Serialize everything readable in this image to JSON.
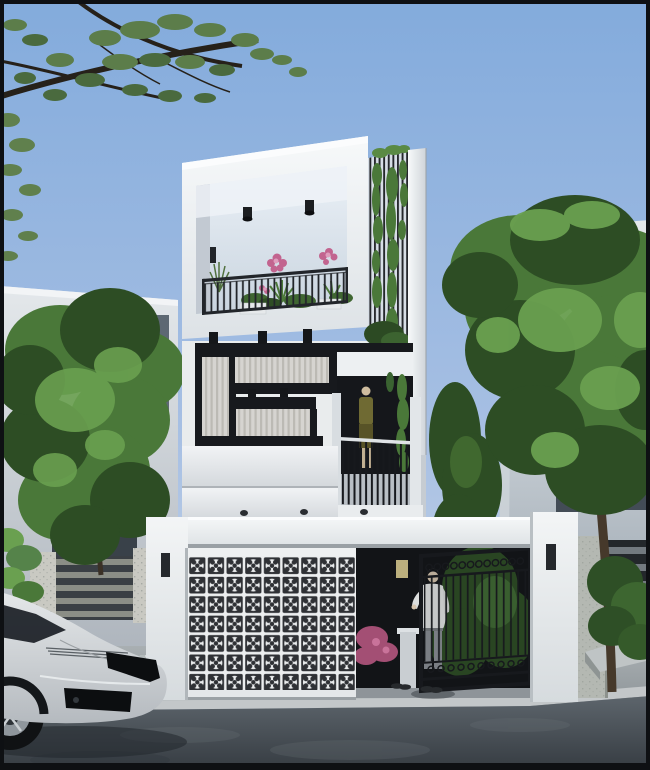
{
  "scene": {
    "subject": "modern-three-storey-townhouse-street-render",
    "setting": "daytime-street-front",
    "main_house": {
      "floors": 3,
      "terrace_ceiling_lights": 2,
      "terrace_wall_sconce": 1,
      "facade_lights_upper_beam": 3,
      "facade_lights_mid_beam": 2,
      "under_parapet_lights": 3,
      "vine_screen": "vertical-slat-screen-with-climbing-plants",
      "balcony_figure": "mannequin-in-olive-dress",
      "breeze_block_gate_grid": {
        "cols": 9,
        "rows": 7
      },
      "fence_wall_sconces": 2,
      "entry_pillar_sconce": 1,
      "terrace_plants": "pink-flowers-and-green-spiky-plants"
    },
    "street": {
      "parked_car": "white-sports-car-front",
      "pedestrian": "man-light-shirt-grey-trousers",
      "shoe_pairs_at_entrance": 2,
      "entry_gate": "dark-wrought-iron-gate-open"
    },
    "vegetation": {
      "top_left": "overhanging-dark-branches-with-leaves",
      "left": "green-tree-in-front-of-left-house",
      "right": "large-green-tree-with-shrub-and-planter"
    },
    "neighbors": {
      "left": "white-two-storey-house-with-slot-windows",
      "right": "white-multi-storey-house-behind-tree"
    }
  },
  "palette": {
    "sky_top": "#83abdc",
    "sky_mid": "#a6bfe3",
    "sky_low": "#cfd9e8",
    "white_hi": "#f7f9fa",
    "white_md": "#e9eced",
    "white_lo": "#cfd4d9",
    "frame_dark": "#17191d",
    "rail": "#22252a",
    "glass": "#d6d4d0",
    "curtain": "#b3b1ab",
    "window_dark": "#434c56",
    "recess": "#15171b",
    "wall_n_hi": "#e4e8eb",
    "wall_n_lo": "#aeb5bd",
    "foliage_dark": "#2d4d24",
    "foliage_mid": "#4a7839",
    "foliage_hi": "#6aa050",
    "foliage_olive": "#5c7d4a",
    "branch": "#26211a",
    "trunk": "#46392b",
    "flower": "#c2648f",
    "flower_hi": "#df9dbd",
    "concrete": "#b4b8b2",
    "slat_light": "#8b8e86",
    "fence_dark": "#23272b",
    "walk_hi": "#a9afb2",
    "walk_lo": "#8d9498",
    "apron": "#b6bcbe",
    "curb": "#c3c7c9",
    "road_hi": "#5d656c",
    "road_lo": "#363c42",
    "car_hi": "#e4e7e9",
    "car_lo": "#b5babf",
    "car_dark": "#0c0e10",
    "skin": "#d6c5ae",
    "shirt": "#e4e6e5",
    "pants": "#8b9095",
    "lit_window": "#cfc189",
    "pedestal": "#c9ced2",
    "border": "#0e1013"
  }
}
